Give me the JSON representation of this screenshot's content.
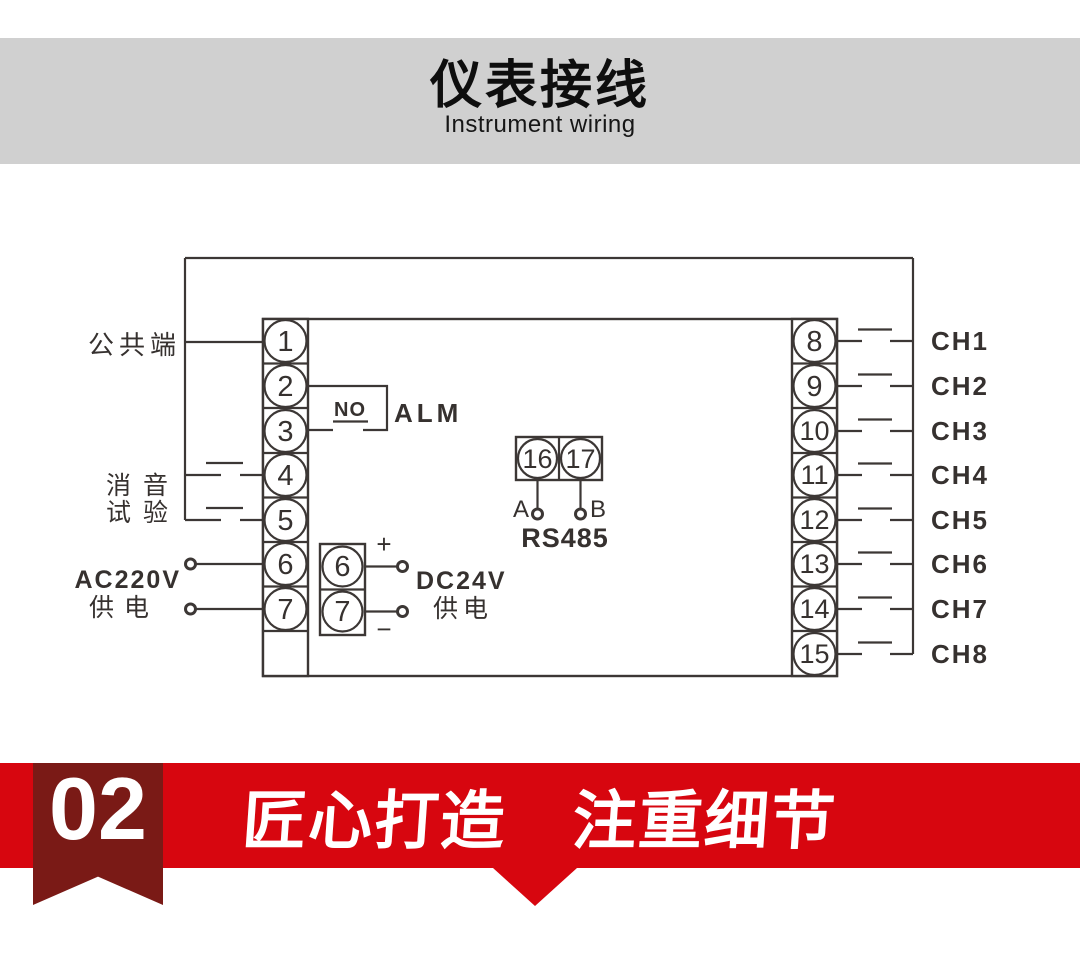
{
  "header": {
    "title": "仪表接线",
    "subtitle": "Instrument wiring"
  },
  "diagram": {
    "left_labels": {
      "common": "公共端",
      "mute": "消音",
      "test": "试验",
      "ac_line1": "AC220V",
      "ac_line2": "供电"
    },
    "alarm": {
      "no": "NO",
      "alm": "ALM"
    },
    "left_terminals": [
      "1",
      "2",
      "3",
      "4",
      "5",
      "6",
      "7"
    ],
    "right_terminals": [
      "8",
      "9",
      "10",
      "11",
      "12",
      "13",
      "14",
      "15"
    ],
    "channels": [
      "CH1",
      "CH2",
      "CH3",
      "CH4",
      "CH5",
      "CH6",
      "CH7",
      "CH8"
    ],
    "rs485": {
      "t16": "16",
      "t17": "17",
      "a": "A",
      "b": "B",
      "label": "RS485"
    },
    "dc": {
      "t6": "6",
      "t7": "7",
      "plus": "+",
      "minus": "−",
      "line1": "DC24V",
      "line2": "供电"
    }
  },
  "footer": {
    "number": "02",
    "title": "匠心打造　注重细节"
  },
  "colors": {
    "header_gray": "#d0d0d0",
    "banner_red": "#d7060f",
    "ribbon_maroon": "#7a1a16",
    "diagram_line": "#3c3735"
  }
}
